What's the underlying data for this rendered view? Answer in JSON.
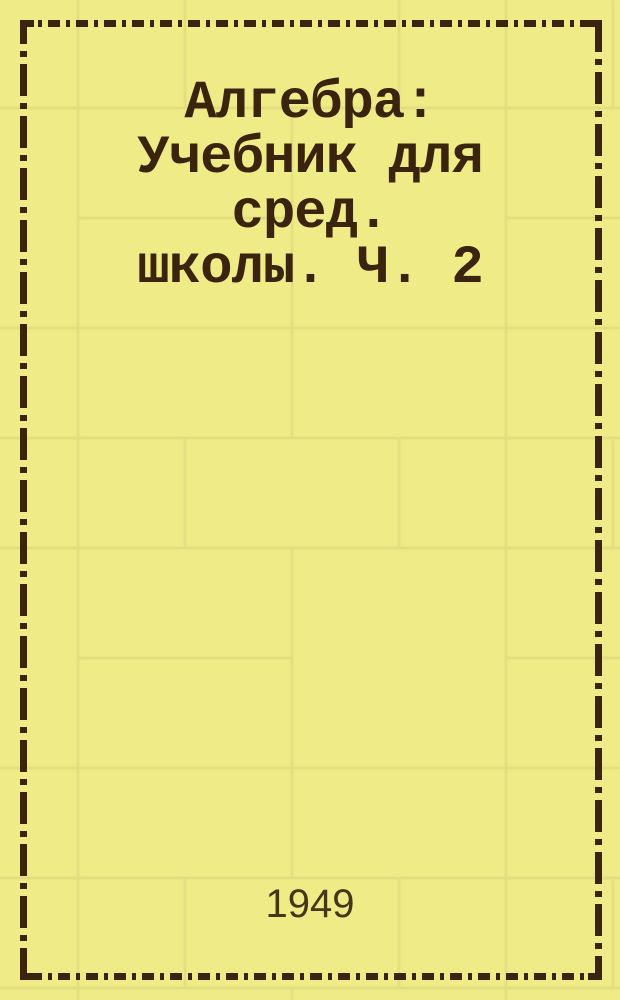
{
  "cover": {
    "title": "Алгебра: Учебник для сред. школы. Ч. 2",
    "title_lines": [
      "Алгебра:",
      "Учебник для",
      "сред.",
      "школы. Ч. 2"
    ],
    "year": "1949"
  },
  "colors": {
    "background": "#efeb86",
    "brick_line": "#ded97c",
    "ink": "#3b240e",
    "year_ink": "#453617"
  }
}
